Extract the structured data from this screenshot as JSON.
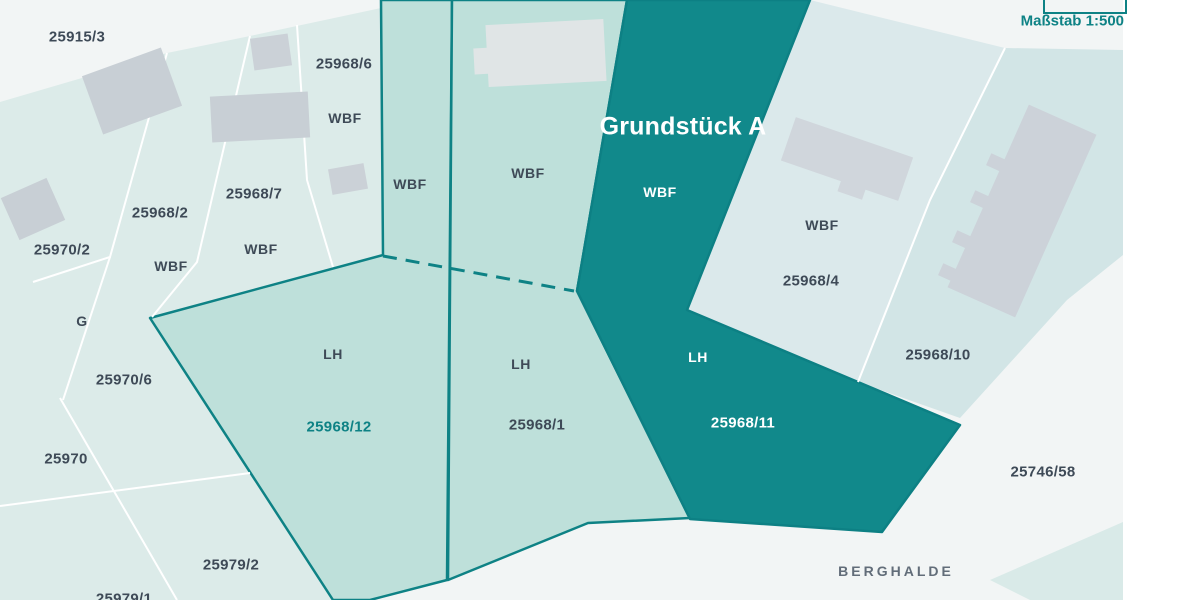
{
  "map": {
    "scale_label": "Maßstab 1:500",
    "highlight_title": "Grundstück A",
    "streets": {
      "top": "KÜHHALDE",
      "bottom": "BERGHALDE"
    },
    "usage_codes": {
      "wbf": "WBF",
      "lh": "LH",
      "g": "G"
    },
    "parcel_numbers": {
      "p25915_3": "25915/3",
      "p25968_6": "25968/6",
      "p25968_2": "25968/2",
      "p25968_7": "25968/7",
      "p25970_2": "25970/2",
      "p25970_6": "25970/6",
      "p25970": "25970",
      "p25979_2": "25979/2",
      "p25979_1": "25979/1",
      "p25968_12": "25968/12",
      "p25968_1": "25968/1",
      "p25968_11": "25968/11",
      "p25968_4": "25968/4",
      "p25968_10": "25968/10",
      "p25746_58": "25746/58"
    },
    "colors": {
      "background": "#f2f5f5",
      "pale_parcel": "#dcebe9",
      "pale_blue_parcel": "#dbe9eb",
      "pale_strip_parcel": "#d2e5e6",
      "mint_parcel": "#bee0da",
      "dark_parcel": "#11898b",
      "border_teal": "#0e8285",
      "boundary_white": "#ffffff",
      "building_gray": "#ccd2d9",
      "text_dark": "#3e4a57",
      "text_teal": "#0e8285",
      "street_gray": "#626d79"
    }
  }
}
